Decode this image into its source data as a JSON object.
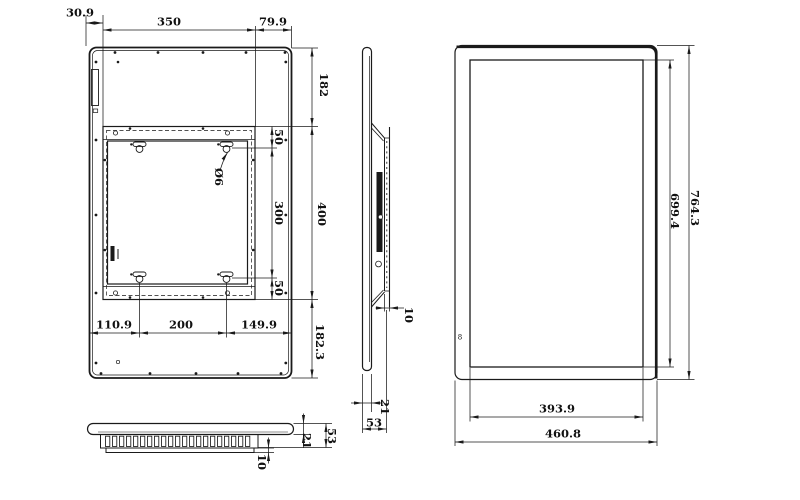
{
  "views": {
    "back": {
      "label": "back-view",
      "dims": {
        "offset_left": "30.9",
        "plate_width": "350",
        "offset_right": "79.9",
        "top_margin": "182",
        "plate_height": "400",
        "bottom_margin": "182.3",
        "hole_margin_top": "50",
        "hole_pitch_vertical": "300",
        "hole_margin_bottom": "50",
        "hole_diameter": "Ø6",
        "hole_left": "110.9",
        "hole_pitch_horizontal": "200",
        "hole_right": "149.9"
      }
    },
    "side": {
      "label": "side-view",
      "dims": {
        "mount_standoff": "10",
        "front_thickness": "21",
        "total_depth": "53"
      }
    },
    "front": {
      "label": "front-view",
      "marking": "8",
      "dims": {
        "screen_height": "699.4",
        "overall_height": "764.3",
        "screen_width": "393.9",
        "overall_width": "460.8"
      }
    },
    "bottom": {
      "label": "bottom-view",
      "dims": {
        "rear_plate_offset": "10",
        "front_thickness": "21",
        "total_depth": "53"
      }
    }
  },
  "colors": {
    "line": "#1a1a1a",
    "background": "#ffffff"
  }
}
